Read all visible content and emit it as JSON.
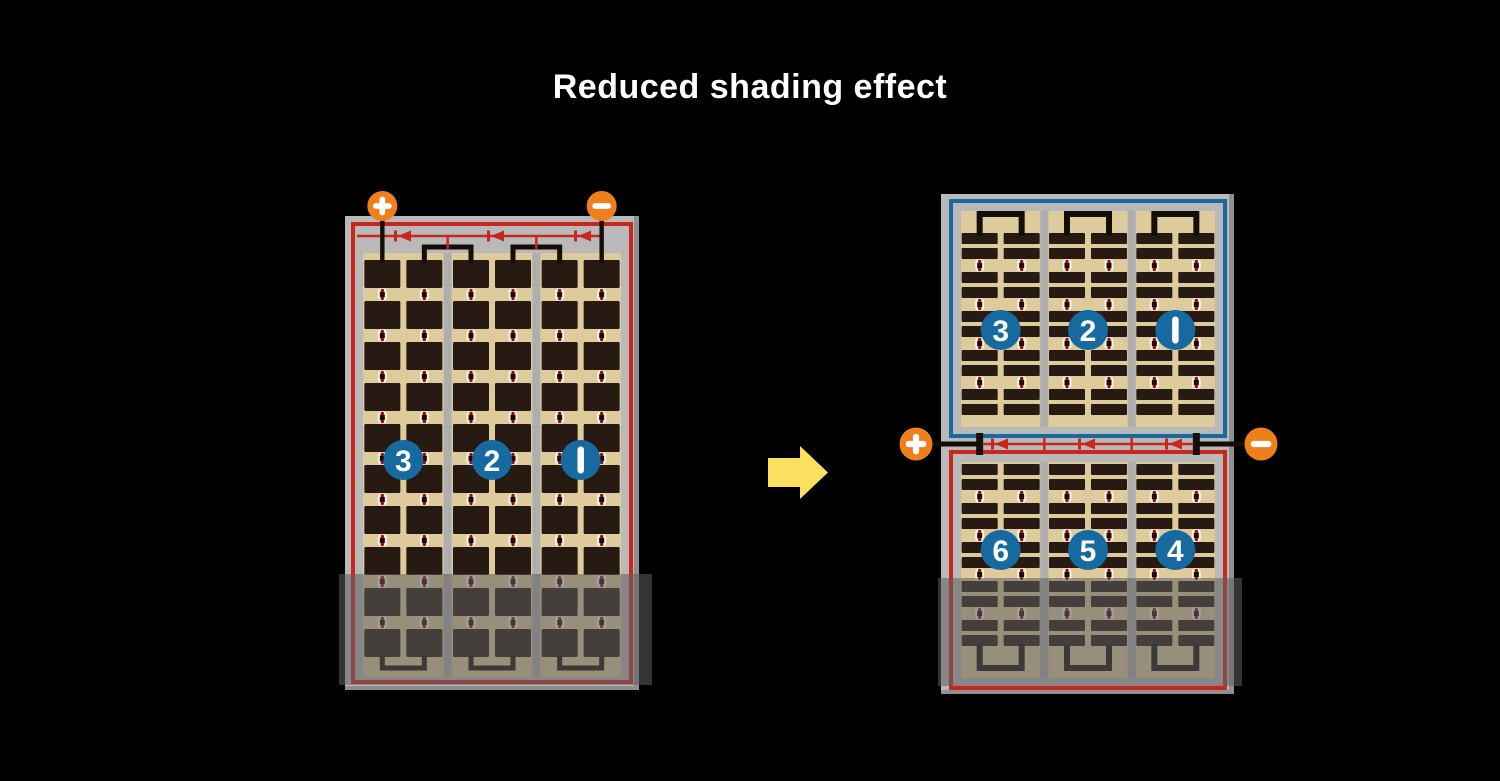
{
  "title": "Reduced shading effect",
  "colors": {
    "background": "#000000",
    "title_text": "#ffffff",
    "frame_gray": "#b9b9b9",
    "frame_edge_gray": "#8f8f8f",
    "divider_gray": "#aeaeae",
    "cell_tan": "#ddcb9b",
    "cell_dark": "#261a12",
    "wire_black": "#150d08",
    "loop_red": "#c9271e",
    "half_blue": "#166a9f",
    "badge_blue": "#166a9f",
    "badge_text": "#ffffff",
    "terminal_orange": "#ef7f1a",
    "terminal_glyph": "#ffffff",
    "arrow_yellow": "#fae05e",
    "marker_white": "#f7f3ea",
    "marker_red": "#c00000",
    "shade_overlay": "rgba(95,95,95,0.55)"
  },
  "left_panel": {
    "terminals": {
      "positive_label": "+",
      "negative_label": "−"
    },
    "cell_strings": [
      {
        "label": "3"
      },
      {
        "label": "2"
      },
      {
        "label": "1"
      }
    ],
    "columns": 3,
    "cells_per_row_in_column": 2,
    "cell_rows": 10,
    "bypass_diode_count": 3,
    "shaded_bottom": true
  },
  "arrow": {
    "direction": "right"
  },
  "right_panel": {
    "terminals": {
      "positive_label": "+",
      "negative_label": "−"
    },
    "halves": [
      {
        "border_color_name": "blue",
        "cell_strings": [
          {
            "label": "3"
          },
          {
            "label": "2"
          },
          {
            "label": "1"
          }
        ]
      },
      {
        "border_color_name": "red",
        "cell_strings": [
          {
            "label": "6"
          },
          {
            "label": "5"
          },
          {
            "label": "4"
          }
        ]
      }
    ],
    "columns": 3,
    "bar_rows_per_half": 10,
    "bypass_diode_count": 3,
    "shaded_bottom": true
  }
}
